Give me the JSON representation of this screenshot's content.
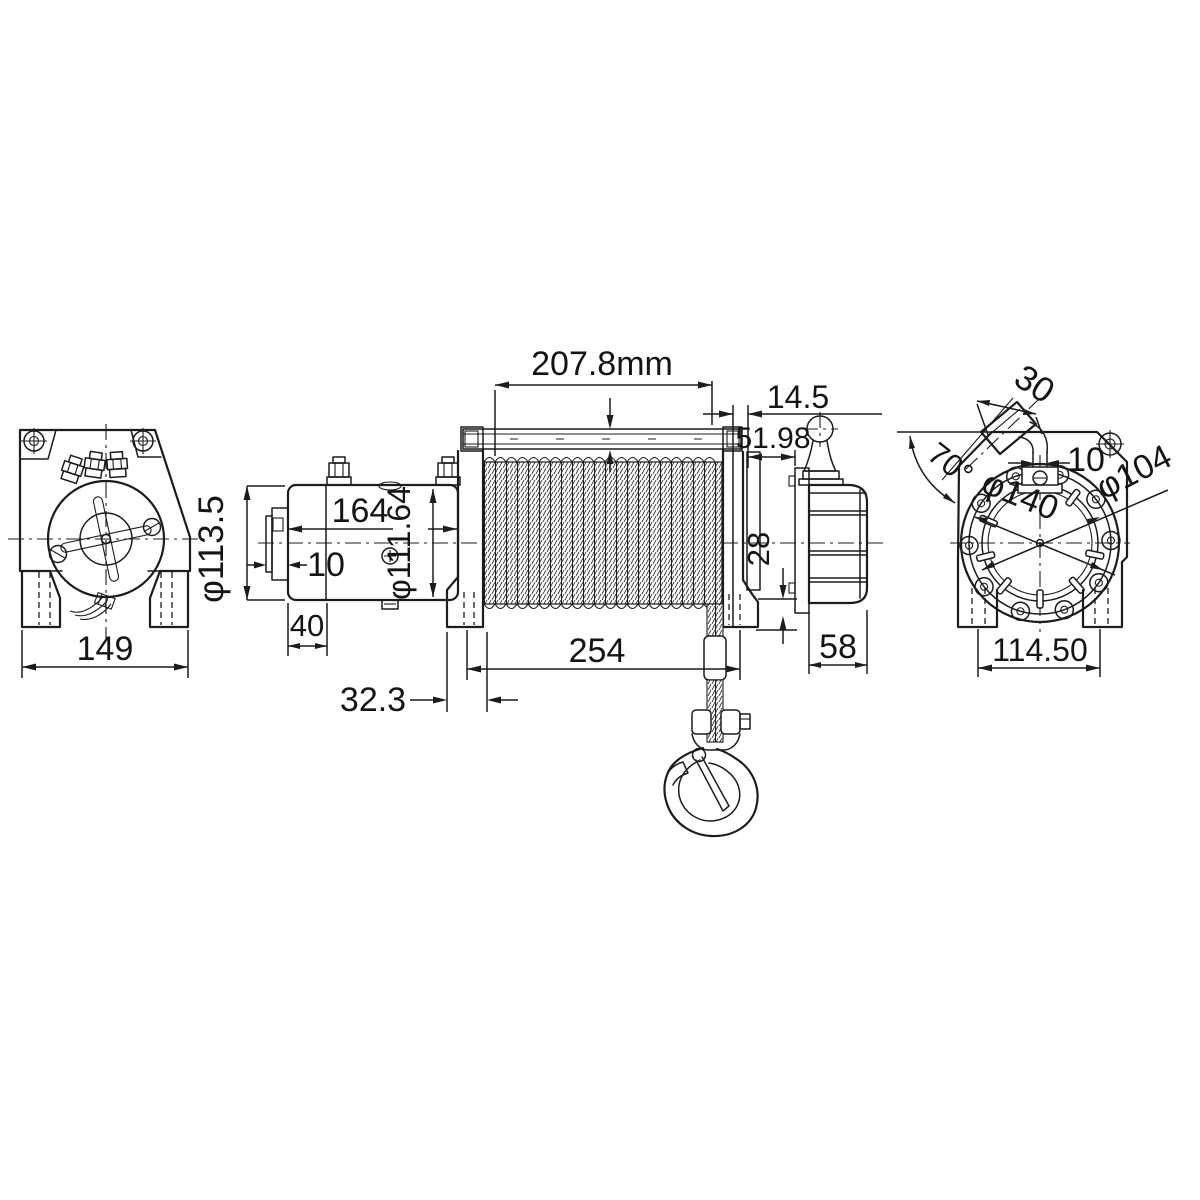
{
  "drawing": {
    "kind": "technical-dimensional-drawing",
    "subject": "electric winch, three orthographic views with hook",
    "background": "#ffffff",
    "line_color": "#1c1c1c"
  },
  "views": {
    "left": {
      "name": "motor end view",
      "dims": {
        "overall_width": "149",
        "motor_diameter": "φ113.5"
      }
    },
    "side": {
      "name": "front side view",
      "dims": {
        "drum_length": "207.8mm",
        "end_gap": "14.5",
        "clutch_offset": "51.98",
        "motor_length": "164",
        "end_cap": "10",
        "drum_diameter": "φ111.64",
        "motor_foot": "40",
        "mount_spacing": "254",
        "foot_width": "32.3",
        "housing_drop": "28",
        "housing_width": "58"
      }
    },
    "right": {
      "name": "gearbox end view",
      "dims": {
        "lever_grip": "30",
        "lever_angle": "70°",
        "stem_width": "10",
        "bolt_circle": "φ140",
        "pilot_diameter": "φ104",
        "foot_spacing": "114.50"
      }
    }
  }
}
